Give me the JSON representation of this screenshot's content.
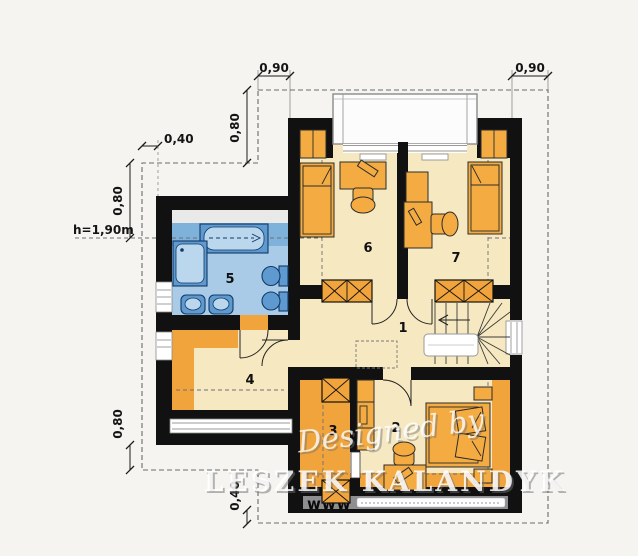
{
  "plan": {
    "rooms": {
      "r1": "1",
      "r2": "2",
      "r3": "3",
      "r4": "4",
      "r5": "5",
      "r6": "6",
      "r7": "7"
    },
    "dimensions": {
      "top_left": "0,90",
      "top_right": "0,90",
      "upper_left_vertical": "0,80",
      "upper_left_horizontal": "0,40",
      "left_vertical": "0,80",
      "height_label": "h=1,90m",
      "bottom_left_vertical": "0,80",
      "bottom_vertical": "0,40"
    },
    "watermark": {
      "script": "Designed by",
      "name": "LESZEK KALANDYK",
      "url_prefix": "www"
    },
    "colors": {
      "bg": "#f5f4f1",
      "wall": "#111111",
      "floor": "#f6e9c1",
      "band": "#f1a43c",
      "furn": "#f4ac42",
      "bathlight": "#a9cbe7",
      "bathdark": "#7fb2db",
      "fix": "#5e9ad0",
      "fixlight": "#bad7ee",
      "fixstroke": "#123a66",
      "roofgray": "#8f8f92",
      "knee": "#e9e9e7"
    }
  }
}
